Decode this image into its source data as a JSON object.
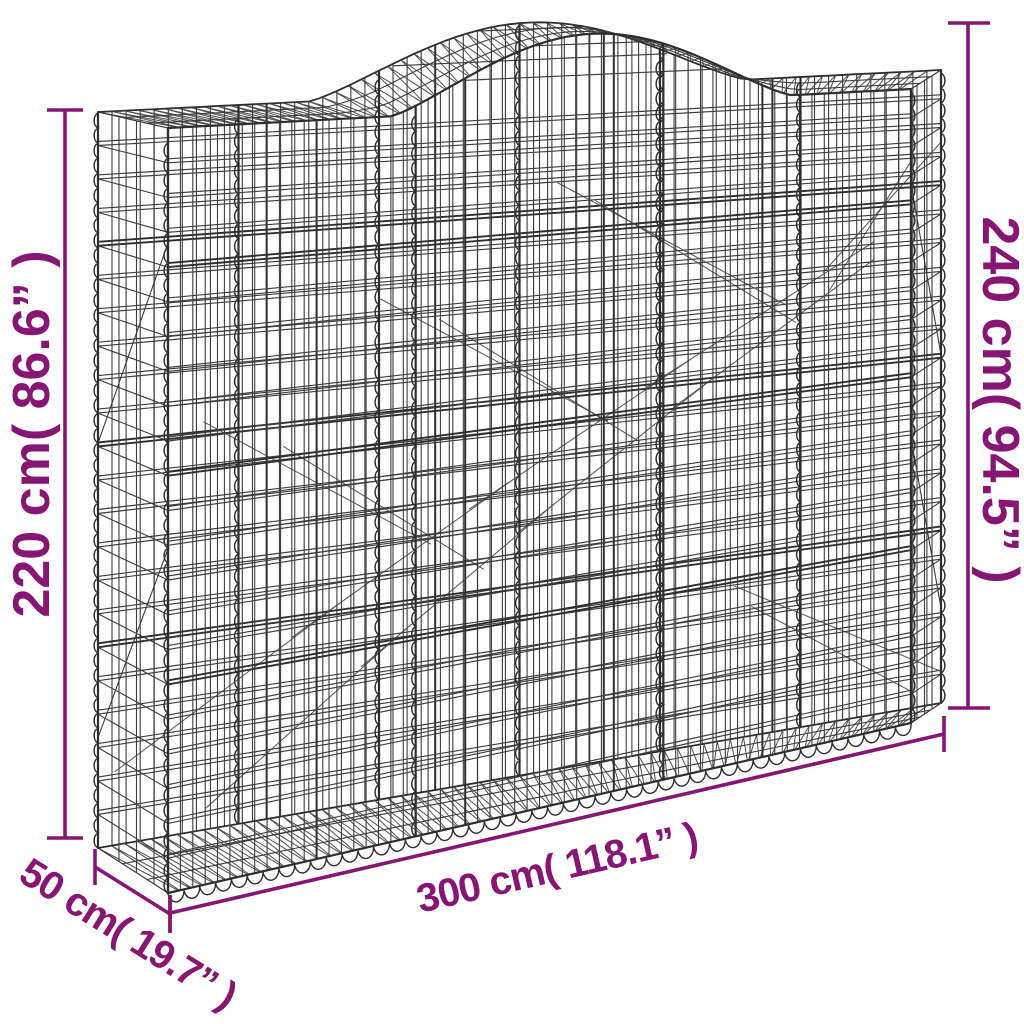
{
  "figure": {
    "name": "arched-gabion-basket-wireframe-diagram",
    "dimensions": {
      "height_left": {
        "label": "220 cm( 86.6” )"
      },
      "height_right": {
        "label": "240 cm( 94.5” )"
      },
      "width": {
        "label": "300 cm( 118.1” )"
      },
      "depth": {
        "label": "50 cm( 19.7” )"
      }
    },
    "colors": {
      "dimension": "#871573",
      "wire": "#3d3d3d",
      "wire_dark": "#2e2e2e",
      "background": "#ffffff"
    }
  }
}
